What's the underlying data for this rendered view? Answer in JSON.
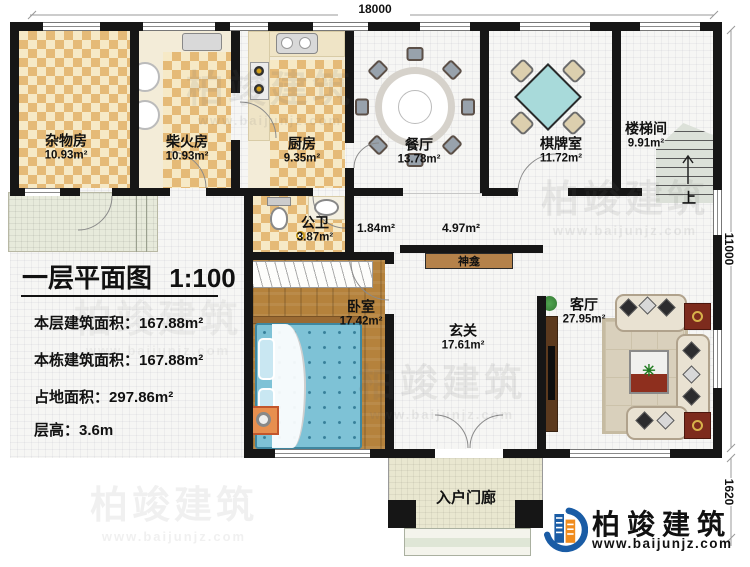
{
  "title": {
    "text": "一层平面图",
    "scale": "1:100"
  },
  "stats": [
    {
      "label": "本层建筑面积：",
      "value": "167.88m²"
    },
    {
      "label": "本栋建筑面积：",
      "value": "167.88m²"
    },
    {
      "label": "占地面积：",
      "value": "297.86m²"
    },
    {
      "label": "层高：",
      "value": "3.6m"
    }
  ],
  "dimensions": {
    "top": "18000",
    "right": "11000",
    "bottom_right": "1620"
  },
  "rooms": [
    {
      "name": "杂物房",
      "area": "10.93m²"
    },
    {
      "name": "柴火房",
      "area": "10.93m²"
    },
    {
      "name": "厨房",
      "area": "9.35m²"
    },
    {
      "name": "餐厅",
      "area": "13.78m²"
    },
    {
      "name": "棋牌室",
      "area": "11.72m²"
    },
    {
      "name": "楼梯间",
      "area": "9.91m²"
    },
    {
      "name": "公卫",
      "area": "3.87m²"
    },
    {
      "name": "卧室",
      "area": "17.42m²"
    },
    {
      "name": "玄关",
      "area": "17.61m²"
    },
    {
      "name": "客厅",
      "area": "27.95m²"
    }
  ],
  "hall_areas": [
    {
      "value": "1.84m²"
    },
    {
      "value": "4.97m²"
    }
  ],
  "features": {
    "shrine": "神龛",
    "porch": "入户门廊",
    "stairs_up": "上"
  },
  "icons": {
    "plant": "✳"
  },
  "watermark": {
    "name": "柏竣建筑",
    "url": "www.baijunjz.com"
  },
  "logo": {
    "name": "柏竣建筑",
    "url": "www.baijunjz.com"
  },
  "colors": {
    "wall": "#161616",
    "accent_blue": "#1a5ca5",
    "accent_orange": "#f08c1e",
    "checker_dark": "#e5ba77",
    "checker_light": "#f6e9c6",
    "wood": "#b5823c",
    "bed_teal": "#7ec2d6",
    "table_red": "#7d2b1d"
  }
}
